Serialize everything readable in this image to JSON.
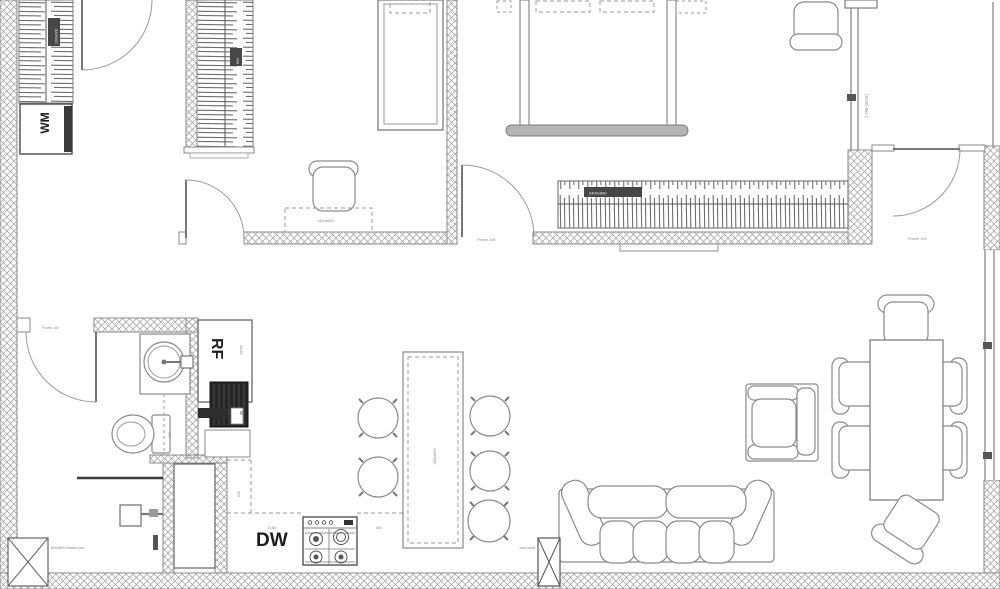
{
  "plan": {
    "appliances": {
      "washer": "WM",
      "fridge": "RF",
      "dishwasher": "DW"
    },
    "dims": {
      "bedroom_window": "1 768 (2615)",
      "closet_left": "1600x600",
      "closet_right": "600",
      "wardrobe": "2400x600",
      "desk": "1400x600",
      "island": "1800x600",
      "fridge_side": "60x60",
      "boiler": "60",
      "dw_cabinet": "D-60",
      "counter": "600",
      "counter_depth": "600",
      "bath_screen": "600"
    },
    "doors": {
      "bedroom": "Proem 100",
      "balcony": "Proem 100",
      "bathroom": "Proem 100"
    },
    "notes": {
      "shower": "800x800 shower pan",
      "vent": "vent shaft"
    }
  },
  "colors": {
    "line": "#8a8a8a",
    "wall_hatch": "#a6a6a6",
    "dark": "#2b2b2b",
    "text": "#333333",
    "background": "#ffffff"
  }
}
